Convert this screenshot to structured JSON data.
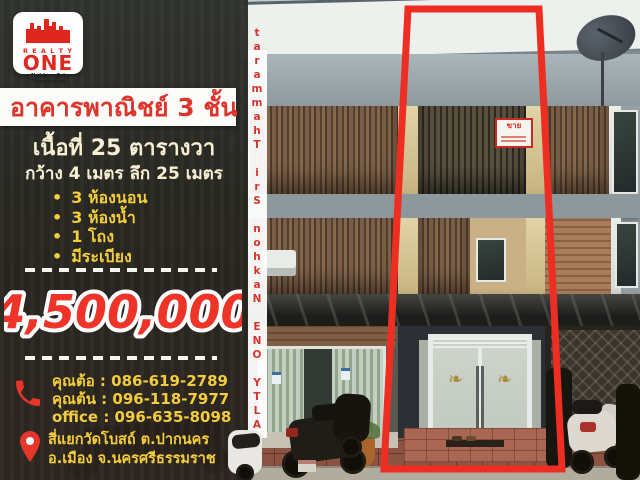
{
  "logo": {
    "realty": "R E A L T Y",
    "one": "ONE",
    "branch": "Nakhon Sri Thammarat"
  },
  "vertical_banner": {
    "text": "REALTY ONE Nakhon Sri Thammarat"
  },
  "listing": {
    "title": "อาคารพาณิชย์ 3 ชั้น",
    "area": "เนื้อที่ 25 ตารางวา",
    "dimensions": "กว้าง 4 เมตร ลึก 25 เมตร",
    "features": [
      "3 ห้องนอน",
      "3 ห้องน้ำ",
      "1 โถง",
      "มีระเบียง"
    ],
    "price": "4,500,000"
  },
  "contact": {
    "lines": [
      "คุณต้อ : 086-619-2789",
      "คุณต้น : 096-118-7977",
      "office : 096-635-8098"
    ]
  },
  "location": {
    "line1": "สี่แยกวัดโบสถ์ ต.ปากนคร",
    "line2": "อ.เมือง จ.นครศรีธรรมราช"
  },
  "photo": {
    "sale_sign_text": "ขาย"
  },
  "colors": {
    "accent_red": "#e6352b",
    "highlight_red": "#ee2e22",
    "text_yellow": "#f3cd3e",
    "text_cream": "#f7efd3"
  }
}
